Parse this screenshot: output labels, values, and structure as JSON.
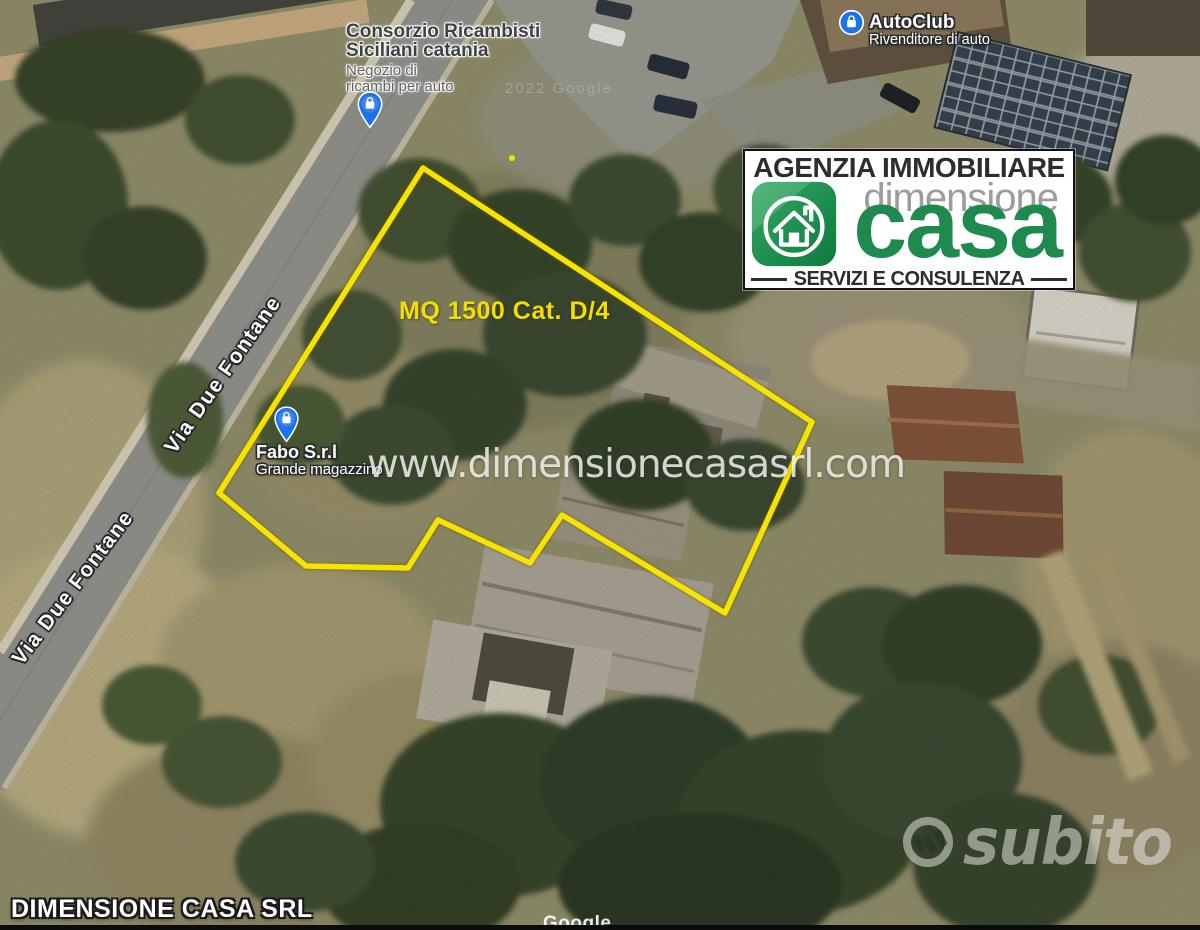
{
  "colors": {
    "boundary_yellow": "#f6e400",
    "annotation_yellow": "#f0df00",
    "logo_green": "#1e8a4e",
    "logo_gray": "#9c9c9c",
    "logo_dark": "#2d2d2d",
    "pin_blue": "#1a73e8"
  },
  "map": {
    "boundary_points": [
      [
        423,
        168
      ],
      [
        812,
        422
      ],
      [
        725,
        613
      ],
      [
        562,
        515
      ],
      [
        530,
        563
      ],
      [
        438,
        520
      ],
      [
        408,
        568
      ],
      [
        306,
        566
      ],
      [
        219,
        493
      ]
    ],
    "area_annotation": "MQ 1500 Cat. D/4",
    "street_labels": [
      {
        "text": "Via Due Fontane"
      },
      {
        "text": "Via Due Fontane"
      }
    ],
    "poi": {
      "consorzio": {
        "name_line1": "Consorzio Ricambisti",
        "name_line2": "Siciliani catania",
        "subtitle_line1": "Negozio di",
        "subtitle_line2": "ricambi per auto"
      },
      "autoclub": {
        "name": "AutoClub",
        "subtitle": "Rivenditore di auto"
      },
      "fabo": {
        "name": "Fabo S.r.l",
        "subtitle": "Grande magazzino"
      }
    },
    "imagery_credit": "2022 Google",
    "google_logo": "Google"
  },
  "branding": {
    "agency_header": "AGENZIA IMMOBILIARE",
    "brand_top": "dimensione",
    "brand_main": "casa",
    "tagline": "SERVIZI E CONSULENZA",
    "website_watermark": "www.dimensionecasasrl.com",
    "footer_label": "DIMENSIONE CASA SRL",
    "marketplace_watermark": "subito"
  }
}
